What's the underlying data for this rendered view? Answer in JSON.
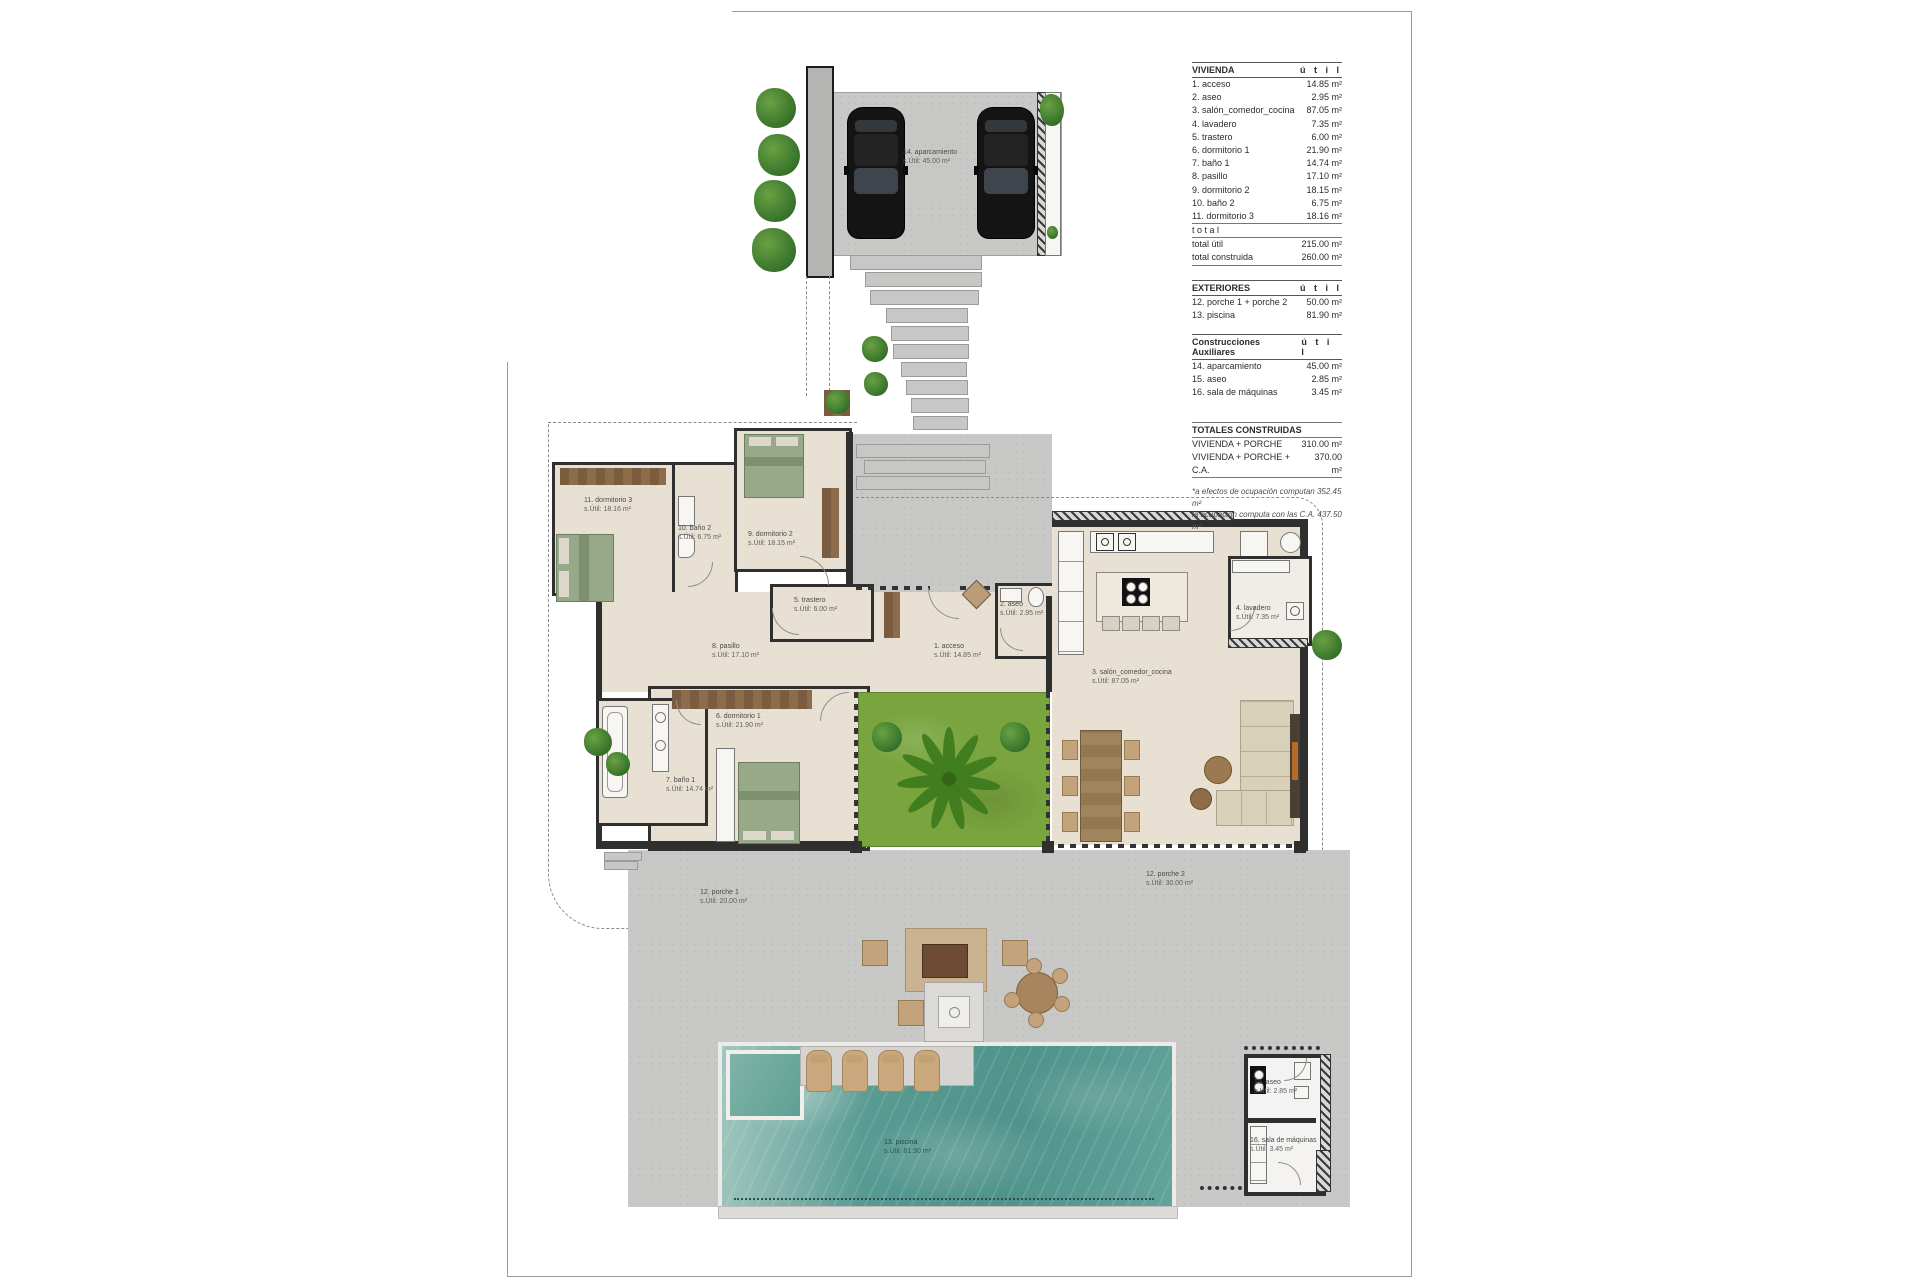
{
  "legend": {
    "vivienda": {
      "title": "VIVIENDA",
      "unit": "ú t i l",
      "rows": [
        {
          "n": "1. acceso",
          "v": "14.85 m²"
        },
        {
          "n": "2. aseo",
          "v": "2.95 m²"
        },
        {
          "n": "3. salón_comedor_cocina",
          "v": "87.05 m²"
        },
        {
          "n": "4. lavadero",
          "v": "7.35 m²"
        },
        {
          "n": "5. trastero",
          "v": "6.00 m²"
        },
        {
          "n": "6. dormitorio 1",
          "v": "21.90 m²"
        },
        {
          "n": "7. baño 1",
          "v": "14.74 m²"
        },
        {
          "n": "8. pasillo",
          "v": "17.10 m²"
        },
        {
          "n": "9. dormitorio 2",
          "v": "18.15 m²"
        },
        {
          "n": "10. baño 2",
          "v": "6.75 m²"
        },
        {
          "n": "11. dormitorio 3",
          "v": "18.16 m²"
        }
      ],
      "total_word": "t o t a l",
      "totals": [
        {
          "n": "total útil",
          "v": "215.00 m²"
        },
        {
          "n": "total construida",
          "v": "260.00 m²"
        }
      ]
    },
    "exteriores": {
      "title": "EXTERIORES",
      "unit": "ú t i l",
      "rows": [
        {
          "n": "12. porche 1 + porche 2",
          "v": "50.00 m²"
        },
        {
          "n": "13. piscina",
          "v": "81.90 m²"
        }
      ]
    },
    "auxiliares": {
      "title": "Construcciones Auxiliares",
      "unit": "ú t i l",
      "rows": [
        {
          "n": "14. aparcamiento",
          "v": "45.00 m²"
        },
        {
          "n": "15. aseo",
          "v": "2.85 m²"
        },
        {
          "n": "16. sala de máquinas",
          "v": "3.45 m²"
        }
      ]
    },
    "totales": {
      "title": "TOTALES CONSTRUIDAS",
      "rows": [
        {
          "n": "VIVIENDA + PORCHE",
          "v": "310.00 m²"
        },
        {
          "n": "VIVIENDA + PORCHE + C.A.",
          "v": "370.00 m²"
        }
      ]
    },
    "footnote1": "*a efectos de ocupación computan 352.45 m²",
    "footnote2": "la ocupación computa con las C.A. 437.50 m²"
  },
  "plan": {
    "labels": [
      {
        "t": "14. aparcamiento",
        "a": "s.Útil: 45.00 m²"
      },
      {
        "t": "11. dormitorio 3",
        "a": "s.Útil: 18.16 m²"
      },
      {
        "t": "10. baño 2",
        "a": "s.Útil: 6.75 m²"
      },
      {
        "t": "9. dormitorio 2",
        "a": "s.Útil: 18.15 m²"
      },
      {
        "t": "5. trastero",
        "a": "s.Útil: 6.00 m²"
      },
      {
        "t": "2. aseo",
        "a": "s.Útil: 2.95 m²"
      },
      {
        "t": "1. acceso",
        "a": "s.Útil: 14.85 m²"
      },
      {
        "t": "4. lavadero",
        "a": "s.Útil: 7.35 m²"
      },
      {
        "t": "3. salón_comedor_cocina",
        "a": "s.Útil: 87.05 m²"
      },
      {
        "t": "8. pasillo",
        "a": "s.Útil: 17.10 m²"
      },
      {
        "t": "6. dormitorio 1",
        "a": "s.Útil: 21.90 m²"
      },
      {
        "t": "7. baño 1",
        "a": "s.Útil: 14.74 m²"
      },
      {
        "t": "12. porche 1",
        "a": "s.Útil: 20.00 m²"
      },
      {
        "t": "12. porche 2",
        "a": "s.Útil: 30.00 m²"
      },
      {
        "t": "13. piscina",
        "a": "s.Útil: 81.90 m²"
      },
      {
        "t": "15. aseo",
        "a": "s.Útil: 2.85 m²"
      },
      {
        "t": "16. sala de máquinas",
        "a": "s.Útil: 3.45 m²"
      }
    ]
  },
  "colors": {
    "wall": "#2f2f2f",
    "floor": "#e8e1d3",
    "concrete": "#c8c8c6",
    "grass": "#79a43e",
    "water": "#579a91",
    "wood": "#8d6c4c",
    "lounger_tan": "#c9a87d",
    "bush_green": "#3e7a2e"
  }
}
